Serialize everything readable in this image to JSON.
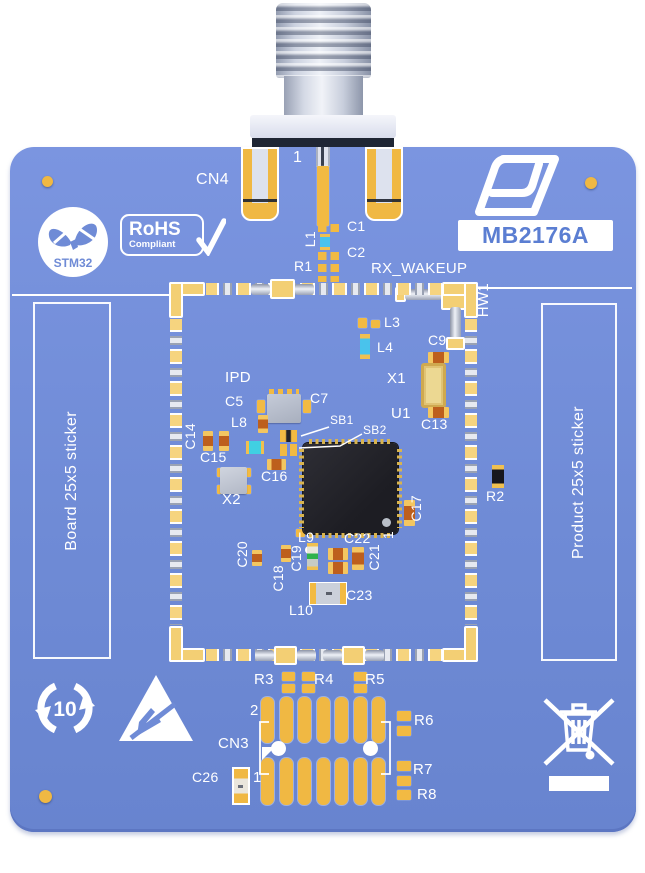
{
  "meta": {
    "product_code": "MB2176A",
    "brand": "ST",
    "module_logo": "STM32",
    "rohs_line1": "RoHS",
    "rohs_line2": "Compliant",
    "recycle_number": "10",
    "sticker_left": "Board 25x5 sticker",
    "sticker_right": "Product 25x5 sticker"
  },
  "colors": {
    "board_blue": "#6f8bd6",
    "pad_gold": "#f0b843",
    "silkscreen_white": "#ffffff",
    "chip_black": "#24242a",
    "badge_text_blue": "#5b7ed2"
  },
  "silkscreen": [
    {
      "t": "CN4",
      "x": 196,
      "y": 172,
      "s": 16
    },
    {
      "t": "1",
      "x": 293,
      "y": 150,
      "s": 16
    },
    {
      "t": "C1",
      "x": 347,
      "y": 219
    },
    {
      "t": "L1",
      "x": 303,
      "y": 231,
      "r": 1
    },
    {
      "t": "C2",
      "x": 347,
      "y": 245
    },
    {
      "t": "R1",
      "x": 294,
      "y": 259
    },
    {
      "t": "RX_WAKEUP",
      "x": 371,
      "y": 261,
      "s": 15
    },
    {
      "t": "HW1",
      "x": 476,
      "y": 283,
      "s": 15,
      "r": 1
    },
    {
      "t": "L3",
      "x": 384,
      "y": 315
    },
    {
      "t": "L4",
      "x": 377,
      "y": 340
    },
    {
      "t": "C9",
      "x": 428,
      "y": 333
    },
    {
      "t": "X1",
      "x": 387,
      "y": 371,
      "s": 15
    },
    {
      "t": "U1",
      "x": 391,
      "y": 406,
      "s": 15
    },
    {
      "t": "C13",
      "x": 421,
      "y": 417
    },
    {
      "t": "IPD",
      "x": 225,
      "y": 370,
      "s": 15
    },
    {
      "t": "C5",
      "x": 225,
      "y": 394
    },
    {
      "t": "C7",
      "x": 310,
      "y": 391
    },
    {
      "t": "L8",
      "x": 231,
      "y": 415
    },
    {
      "t": "SB1",
      "x": 330,
      "y": 414,
      "s": 12
    },
    {
      "t": "SB2",
      "x": 363,
      "y": 424,
      "s": 12
    },
    {
      "t": "C14",
      "x": 183,
      "y": 423,
      "r": 1
    },
    {
      "t": "C15",
      "x": 200,
      "y": 450
    },
    {
      "t": "C16",
      "x": 261,
      "y": 469
    },
    {
      "t": "X2",
      "x": 222,
      "y": 492,
      "s": 15
    },
    {
      "t": "C17",
      "x": 409,
      "y": 495,
      "r": 1
    },
    {
      "t": "R2",
      "x": 486,
      "y": 489
    },
    {
      "t": "L9",
      "x": 298,
      "y": 530
    },
    {
      "t": "C22",
      "x": 344,
      "y": 531
    },
    {
      "t": "1",
      "x": 381,
      "y": 531,
      "r": 1
    },
    {
      "t": "C21",
      "x": 367,
      "y": 544,
      "r": 1
    },
    {
      "t": "C20",
      "x": 235,
      "y": 541,
      "r": 1
    },
    {
      "t": "C19",
      "x": 289,
      "y": 545,
      "r": 1
    },
    {
      "t": "C18",
      "x": 271,
      "y": 565,
      "r": 1
    },
    {
      "t": "C23",
      "x": 346,
      "y": 588
    },
    {
      "t": "L10",
      "x": 289,
      "y": 603
    },
    {
      "t": "R3",
      "x": 254,
      "y": 672,
      "s": 15
    },
    {
      "t": "R4",
      "x": 314,
      "y": 672,
      "s": 15
    },
    {
      "t": "R5",
      "x": 365,
      "y": 672,
      "s": 15
    },
    {
      "t": "2",
      "x": 250,
      "y": 703,
      "s": 15
    },
    {
      "t": "CN3",
      "x": 218,
      "y": 736,
      "s": 15
    },
    {
      "t": "C26",
      "x": 192,
      "y": 770
    },
    {
      "t": "1",
      "x": 253,
      "y": 770,
      "s": 15
    },
    {
      "t": "R6",
      "x": 414,
      "y": 713,
      "s": 15
    },
    {
      "t": "R7",
      "x": 413,
      "y": 762,
      "s": 15
    },
    {
      "t": "R8",
      "x": 417,
      "y": 787,
      "s": 15
    }
  ],
  "parts": [
    {
      "cls": "pad-big",
      "x": 241,
      "y": 147,
      "w": 38,
      "h": 74,
      "n": "cn4-ground-pad"
    },
    {
      "cls": "pad-big",
      "x": 365,
      "y": 147,
      "w": 38,
      "h": 74,
      "n": "cn4-ground-pad"
    },
    {
      "cls": "slot-top",
      "x": 316,
      "y": 147,
      "w": 14,
      "h": 20,
      "n": "cn4-pin-slot"
    },
    {
      "cls": "pad",
      "x": 317,
      "y": 166,
      "w": 12,
      "h": 60,
      "n": "cn4-signal-pad"
    },
    {
      "cls": "pads2h",
      "x": 318,
      "y": 224,
      "w": 21,
      "h": 8,
      "n": "c1-pads"
    },
    {
      "cls": "blue-v",
      "x": 320,
      "y": 234,
      "w": 10,
      "h": 16,
      "n": "l1-inductor"
    },
    {
      "cls": "pads2h",
      "x": 318,
      "y": 252,
      "w": 21,
      "h": 8,
      "n": "c2-pads"
    },
    {
      "cls": "pads2h",
      "x": 318,
      "y": 264,
      "w": 21,
      "h": 8,
      "n": "r1-pads"
    },
    {
      "cls": "pads2h",
      "x": 318,
      "y": 276,
      "w": 21,
      "h": 6,
      "n": "pads"
    },
    {
      "cls": "pad-o",
      "x": 395,
      "y": 287,
      "w": 11,
      "h": 15,
      "n": "hw1-pad"
    },
    {
      "cls": "metal-h",
      "x": 405,
      "y": 289,
      "w": 37,
      "h": 11,
      "n": "hw1-wire"
    },
    {
      "cls": "pad-o",
      "x": 441,
      "y": 285,
      "w": 26,
      "h": 25,
      "n": "hw1-corner-pad"
    },
    {
      "cls": "metal-v",
      "x": 450,
      "y": 307,
      "w": 11,
      "h": 33,
      "n": "hw1-wire"
    },
    {
      "cls": "pad-o",
      "x": 446,
      "y": 337,
      "w": 19,
      "h": 13,
      "n": "hw1-pad"
    },
    {
      "cls": "se-h",
      "x": 206,
      "y": 283,
      "w": 236,
      "h": 12,
      "n": "shield-edge-top"
    },
    {
      "cls": "se-h",
      "x": 206,
      "y": 649,
      "w": 236,
      "h": 12,
      "n": "shield-edge-bottom"
    },
    {
      "cls": "se-v",
      "x": 170,
      "y": 319,
      "w": 12,
      "h": 306,
      "n": "shield-edge-left"
    },
    {
      "cls": "se-v",
      "x": 465,
      "y": 319,
      "w": 12,
      "h": 306,
      "n": "shield-edge-right"
    },
    {
      "cls": "sc",
      "x": 169,
      "y": 282,
      "w": 36,
      "h": 14,
      "n": "shield-corner"
    },
    {
      "cls": "sc",
      "x": 169,
      "y": 282,
      "w": 14,
      "h": 36,
      "n": "shield-corner"
    },
    {
      "cls": "sc",
      "x": 442,
      "y": 282,
      "w": 36,
      "h": 14,
      "n": "shield-corner"
    },
    {
      "cls": "sc",
      "x": 464,
      "y": 282,
      "w": 14,
      "h": 36,
      "n": "shield-corner"
    },
    {
      "cls": "sc",
      "x": 169,
      "y": 648,
      "w": 36,
      "h": 14,
      "n": "shield-corner"
    },
    {
      "cls": "sc",
      "x": 169,
      "y": 626,
      "w": 14,
      "h": 36,
      "n": "shield-corner"
    },
    {
      "cls": "sc",
      "x": 442,
      "y": 648,
      "w": 36,
      "h": 14,
      "n": "shield-corner"
    },
    {
      "cls": "sc",
      "x": 464,
      "y": 626,
      "w": 14,
      "h": 36,
      "n": "shield-corner"
    },
    {
      "cls": "metal-h",
      "x": 251,
      "y": 284,
      "w": 19,
      "h": 11,
      "n": "feedthrough-tube"
    },
    {
      "cls": "pad-o",
      "x": 270,
      "y": 279,
      "w": 25,
      "h": 20,
      "n": "rf-feedthrough"
    },
    {
      "cls": "metal-h",
      "x": 295,
      "y": 284,
      "w": 19,
      "h": 11,
      "n": "feedthrough-tube"
    },
    {
      "cls": "metal-h",
      "x": 255,
      "y": 650,
      "w": 19,
      "h": 11,
      "n": "feedthrough-tube"
    },
    {
      "cls": "pad-o",
      "x": 274,
      "y": 646,
      "w": 23,
      "h": 19,
      "n": "feedthrough"
    },
    {
      "cls": "metal-h",
      "x": 297,
      "y": 650,
      "w": 19,
      "h": 11,
      "n": "feedthrough-tube"
    },
    {
      "cls": "metal-h",
      "x": 323,
      "y": 650,
      "w": 19,
      "h": 11,
      "n": "feedthrough-tube"
    },
    {
      "cls": "pad-o",
      "x": 342,
      "y": 646,
      "w": 23,
      "h": 19,
      "n": "feedthrough"
    },
    {
      "cls": "metal-h",
      "x": 365,
      "y": 650,
      "w": 19,
      "h": 11,
      "n": "feedthrough-tube"
    },
    {
      "cls": "pad",
      "x": 358,
      "y": 318,
      "w": 9,
      "h": 10,
      "n": "l3-pad"
    },
    {
      "cls": "pad",
      "x": 371,
      "y": 320,
      "w": 9,
      "h": 8,
      "n": "l3-pad"
    },
    {
      "cls": "blue-v",
      "x": 360,
      "y": 334,
      "w": 10,
      "h": 25,
      "n": "l4-inductor"
    },
    {
      "cls": "cap-h",
      "x": 428,
      "y": 352,
      "w": 21,
      "h": 11,
      "n": "c9-capacitor"
    },
    {
      "cls": "xtal",
      "x": 421,
      "y": 363,
      "w": 25,
      "h": 45,
      "n": "x1-crystal"
    },
    {
      "cls": "cap-h",
      "x": 428,
      "y": 407,
      "w": 21,
      "h": 11,
      "n": "c13-capacitor"
    },
    {
      "cls": "pads-row",
      "x": 269,
      "y": 389,
      "w": 30,
      "h": 6,
      "n": "ipd-pads"
    },
    {
      "cls": "gray-chip",
      "x": 267,
      "y": 394,
      "w": 34,
      "h": 29,
      "n": "ipd-chip"
    },
    {
      "cls": "pad",
      "x": 257,
      "y": 400,
      "w": 8,
      "h": 13,
      "n": "c5-pad"
    },
    {
      "cls": "pad",
      "x": 303,
      "y": 400,
      "w": 8,
      "h": 13,
      "n": "c7-pad"
    },
    {
      "cls": "cap-v",
      "x": 258,
      "y": 415,
      "w": 10,
      "h": 18,
      "n": "l8-part"
    },
    {
      "cls": "cap-v",
      "x": 203,
      "y": 431,
      "w": 10,
      "h": 20,
      "n": "c14-capacitor"
    },
    {
      "cls": "cap-v",
      "x": 219,
      "y": 431,
      "w": 10,
      "h": 20,
      "n": "c15-capacitor"
    },
    {
      "cls": "blue-h",
      "x": 246,
      "y": 441,
      "w": 18,
      "h": 13,
      "n": "cyan-component"
    },
    {
      "cls": "sb",
      "x": 280,
      "y": 430,
      "w": 17,
      "h": 12,
      "n": "sb1-jumper"
    },
    {
      "cls": "pads2h",
      "x": 280,
      "y": 444,
      "w": 17,
      "h": 12,
      "n": "sb2-pads"
    },
    {
      "cls": "cap-h",
      "x": 267,
      "y": 459,
      "w": 19,
      "h": 11,
      "n": "c16-capacitor"
    },
    {
      "cls": "pad",
      "x": 217,
      "y": 468,
      "w": 7,
      "h": 9,
      "n": "x2-pad"
    },
    {
      "cls": "pad",
      "x": 244,
      "y": 468,
      "w": 7,
      "h": 9,
      "n": "x2-pad"
    },
    {
      "cls": "pad",
      "x": 217,
      "y": 485,
      "w": 7,
      "h": 9,
      "n": "x2-pad"
    },
    {
      "cls": "pad",
      "x": 244,
      "y": 485,
      "w": 7,
      "h": 9,
      "n": "x2-pad"
    },
    {
      "cls": "x2",
      "x": 220,
      "y": 467,
      "w": 27,
      "h": 27,
      "n": "x2-crystal"
    },
    {
      "cls": "cap-v",
      "x": 404,
      "y": 500,
      "w": 11,
      "h": 26,
      "n": "c17-capacitor"
    },
    {
      "cls": "res-v",
      "x": 492,
      "y": 465,
      "w": 12,
      "h": 23,
      "n": "r2-resistor"
    },
    {
      "cls": "pad",
      "x": 296,
      "y": 529,
      "w": 9,
      "h": 8,
      "n": "l9-pad"
    },
    {
      "cls": "wdot",
      "x": 305,
      "y": 546,
      "w": 8,
      "h": 8,
      "n": "via"
    },
    {
      "cls": "green-v",
      "x": 307,
      "y": 543,
      "w": 11,
      "h": 27,
      "n": "c19-component"
    },
    {
      "cls": "cap-h",
      "x": 328,
      "y": 548,
      "w": 20,
      "h": 12,
      "n": "c22-capacitor"
    },
    {
      "cls": "cap-h",
      "x": 328,
      "y": 562,
      "w": 20,
      "h": 12,
      "n": "capacitor"
    },
    {
      "cls": "cap-v",
      "x": 352,
      "y": 547,
      "w": 12,
      "h": 23,
      "n": "c21-capacitor"
    },
    {
      "cls": "cap-v",
      "x": 281,
      "y": 545,
      "w": 10,
      "h": 17,
      "n": "c18-capacitor"
    },
    {
      "cls": "cap-v",
      "x": 252,
      "y": 550,
      "w": 10,
      "h": 16,
      "n": "c20-capacitor"
    },
    {
      "cls": "ind",
      "x": 309,
      "y": 582,
      "w": 38,
      "h": 23,
      "n": "l10-inductor"
    },
    {
      "cls": "pad",
      "x": 282,
      "y": 672,
      "w": 13,
      "h": 9,
      "n": "r3-pad"
    },
    {
      "cls": "pad",
      "x": 282,
      "y": 684,
      "w": 13,
      "h": 9,
      "n": "r3-pad"
    },
    {
      "cls": "pad",
      "x": 302,
      "y": 672,
      "w": 13,
      "h": 9,
      "n": "r4-pad"
    },
    {
      "cls": "pad",
      "x": 302,
      "y": 684,
      "w": 13,
      "h": 9,
      "n": "r4-pad"
    },
    {
      "cls": "pad",
      "x": 354,
      "y": 672,
      "w": 13,
      "h": 9,
      "n": "r5-pad"
    },
    {
      "cls": "pad",
      "x": 354,
      "y": 684,
      "w": 13,
      "h": 9,
      "n": "r5-pad"
    },
    {
      "cls": "cn3pad",
      "x": 261,
      "y": 697,
      "w": 13,
      "h": 46,
      "n": "cn3-pad"
    },
    {
      "cls": "cn3pad",
      "x": 280,
      "y": 697,
      "w": 13,
      "h": 46,
      "n": "cn3-pad"
    },
    {
      "cls": "cn3pad",
      "x": 298,
      "y": 697,
      "w": 13,
      "h": 46,
      "n": "cn3-pad"
    },
    {
      "cls": "cn3pad",
      "x": 317,
      "y": 697,
      "w": 13,
      "h": 46,
      "n": "cn3-pad"
    },
    {
      "cls": "cn3pad",
      "x": 335,
      "y": 697,
      "w": 13,
      "h": 46,
      "n": "cn3-pad"
    },
    {
      "cls": "cn3pad",
      "x": 354,
      "y": 697,
      "w": 13,
      "h": 46,
      "n": "cn3-pad"
    },
    {
      "cls": "cn3pad",
      "x": 372,
      "y": 697,
      "w": 13,
      "h": 46,
      "n": "cn3-pad"
    },
    {
      "cls": "cn3pad",
      "x": 261,
      "y": 758,
      "w": 13,
      "h": 47,
      "n": "cn3-pad"
    },
    {
      "cls": "cn3pad",
      "x": 280,
      "y": 758,
      "w": 13,
      "h": 47,
      "n": "cn3-pad"
    },
    {
      "cls": "cn3pad",
      "x": 298,
      "y": 758,
      "w": 13,
      "h": 47,
      "n": "cn3-pad"
    },
    {
      "cls": "cn3pad",
      "x": 317,
      "y": 758,
      "w": 13,
      "h": 47,
      "n": "cn3-pad"
    },
    {
      "cls": "cn3pad",
      "x": 335,
      "y": 758,
      "w": 13,
      "h": 47,
      "n": "cn3-pad"
    },
    {
      "cls": "cn3pad",
      "x": 354,
      "y": 758,
      "w": 13,
      "h": 47,
      "n": "cn3-pad"
    },
    {
      "cls": "cn3pad",
      "x": 372,
      "y": 758,
      "w": 13,
      "h": 47,
      "n": "cn3-pad"
    },
    {
      "cls": "hole",
      "x": 271,
      "y": 741,
      "w": 15,
      "h": 15,
      "n": "cn3-hole"
    },
    {
      "cls": "hole",
      "x": 363,
      "y": 741,
      "w": 15,
      "h": 15,
      "n": "cn3-hole"
    },
    {
      "cls": "pad",
      "x": 397,
      "y": 711,
      "w": 14,
      "h": 10,
      "n": "r6-pad"
    },
    {
      "cls": "pad",
      "x": 397,
      "y": 726,
      "w": 14,
      "h": 10,
      "n": "r6-pad"
    },
    {
      "cls": "pad",
      "x": 397,
      "y": 761,
      "w": 14,
      "h": 10,
      "n": "r7-pad"
    },
    {
      "cls": "pad",
      "x": 397,
      "y": 776,
      "w": 14,
      "h": 10,
      "n": "r7-pad"
    },
    {
      "cls": "pad",
      "x": 397,
      "y": 790,
      "w": 14,
      "h": 10,
      "n": "r8-pad"
    },
    {
      "cls": "c26",
      "x": 232,
      "y": 767,
      "w": 18,
      "h": 38,
      "n": "c26-capacitor"
    },
    {
      "cls": "fid",
      "x": 42,
      "y": 176,
      "w": 11,
      "h": 11,
      "n": "fiducial"
    },
    {
      "cls": "fid",
      "x": 585,
      "y": 177,
      "w": 12,
      "h": 12,
      "n": "fiducial"
    },
    {
      "cls": "fid",
      "x": 39,
      "y": 790,
      "w": 13,
      "h": 13,
      "n": "fiducial"
    }
  ]
}
